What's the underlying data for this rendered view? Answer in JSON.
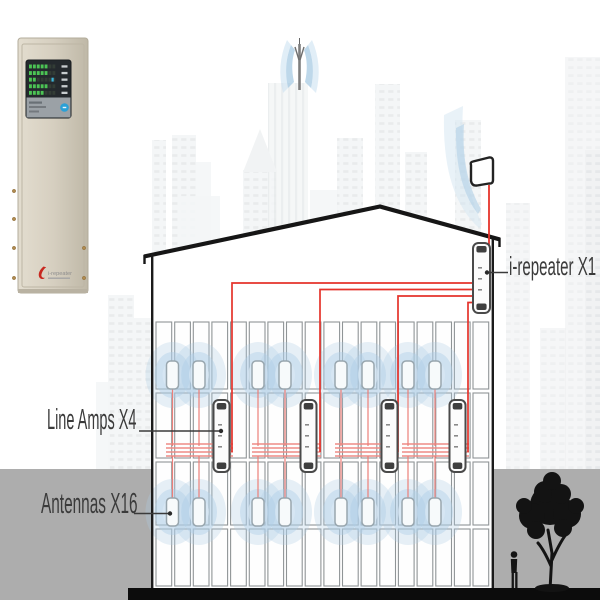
{
  "diagram": {
    "labels": {
      "repeater": "i-repeater X1",
      "line_amps": "Line Amps X4",
      "antennas": "Antennas X16"
    },
    "counts": {
      "repeaters": 1,
      "line_amps": 4,
      "antennas": 16,
      "antennas_per_row": 8
    },
    "cabinet_logo": "i-repeater",
    "colors": {
      "cable_red": "#e5332b",
      "cable_bundle": "#ee8b85",
      "cable_stub": "#ec7f79",
      "ripple_blue": "#aecde6",
      "beam_outer": "#cfe3f1",
      "beam_inner": "#a9cbe4",
      "ground_gray": "#adadad",
      "ground_black": "#0c0c0c",
      "silhouette": "#131313",
      "label_text": "#3b3b3b",
      "device_stroke": "#4a4a4a",
      "cell_stroke": "#8f9496",
      "cabinet_beige": "#d6cfc0",
      "panel_dark": "#24292d",
      "panel_gray": "#9ba1a6",
      "led_green": "#4cc455",
      "led_cyan": "#3ab5dd",
      "button_blue": "#2aa0d6",
      "screw_gold": "#b08a4e",
      "logo_red": "#c8281f"
    }
  }
}
